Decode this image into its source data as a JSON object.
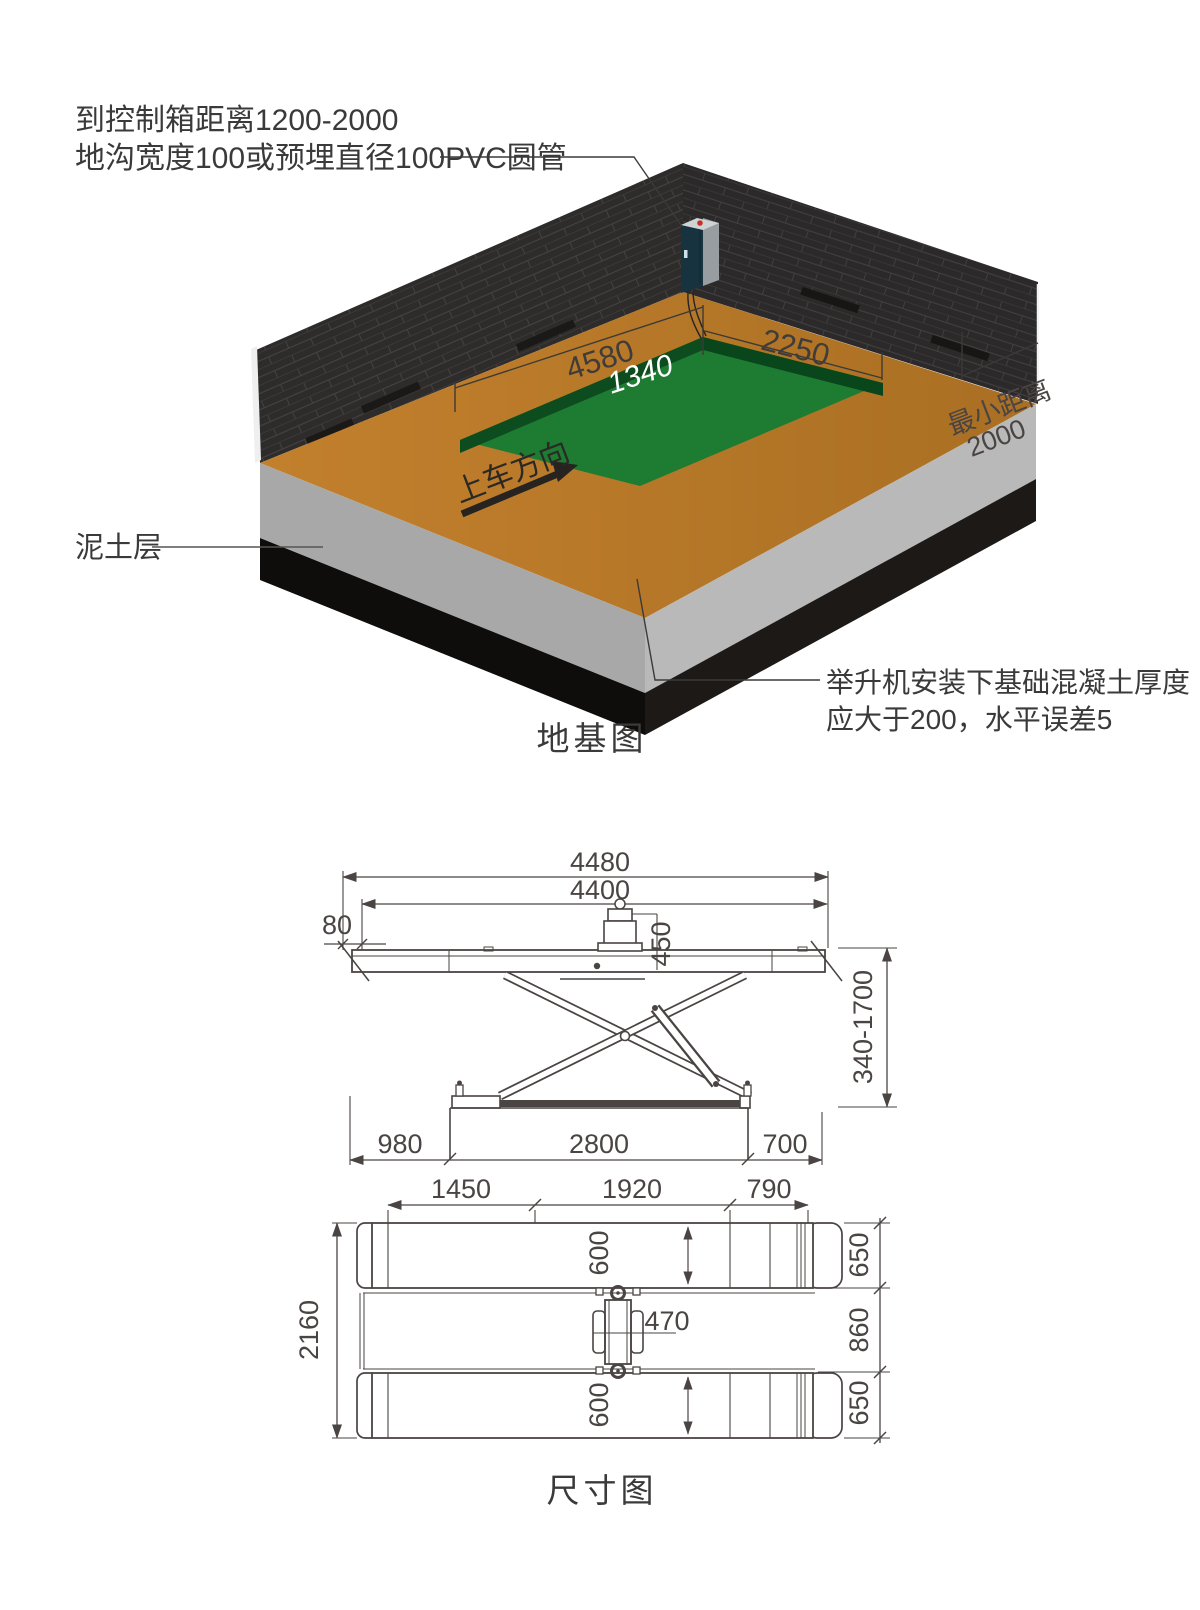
{
  "page": {
    "background": "#ffffff"
  },
  "foundation": {
    "title": "地基图",
    "note_control_box_line1": "到控制箱距离1200-2000",
    "note_control_box_line2": "地沟宽度100或预埋直径100PVC圆管",
    "soil_layer_label": "泥土层",
    "concrete_note_line1": "举升机安装下基础混凝土厚度",
    "concrete_note_line2": "应大于200，水平误差5",
    "dim_pit_length": "4580",
    "dim_pit_inner": "1340",
    "dim_pit_width": "2250",
    "min_distance_label": "最小距离",
    "min_distance_value": "2000",
    "drive_direction_label": "上车方向",
    "colors": {
      "floor": "#bf7d2b",
      "pit": "#1e7b32",
      "pit_wall": "#0c4c1e",
      "wall_brick": "#2e2c2b",
      "concrete_left": "#a8a8a8",
      "concrete_right": "#b9b9b9",
      "soil": "#12100e",
      "control_box": "#16333f",
      "button_red": "#c63322"
    }
  },
  "dimensions": {
    "title": "尺寸图",
    "side_view": {
      "overall_length": "4480",
      "platform_length": "4400",
      "ramp_offset": "80",
      "power_unit_height": "450",
      "lift_height_range": "340-1700",
      "pit_offset_left": "980",
      "pit_length": "2800",
      "pit_offset_right": "700"
    },
    "plan_view": {
      "seg_left": "1450",
      "seg_mid": "1920",
      "seg_right": "790",
      "overall_width": "2160",
      "runway_width_top": "600",
      "runway_width_bottom": "600",
      "center_unit_width": "470",
      "right_top": "650",
      "right_mid": "860",
      "right_bottom": "650"
    }
  },
  "line_color": "#4a4443"
}
